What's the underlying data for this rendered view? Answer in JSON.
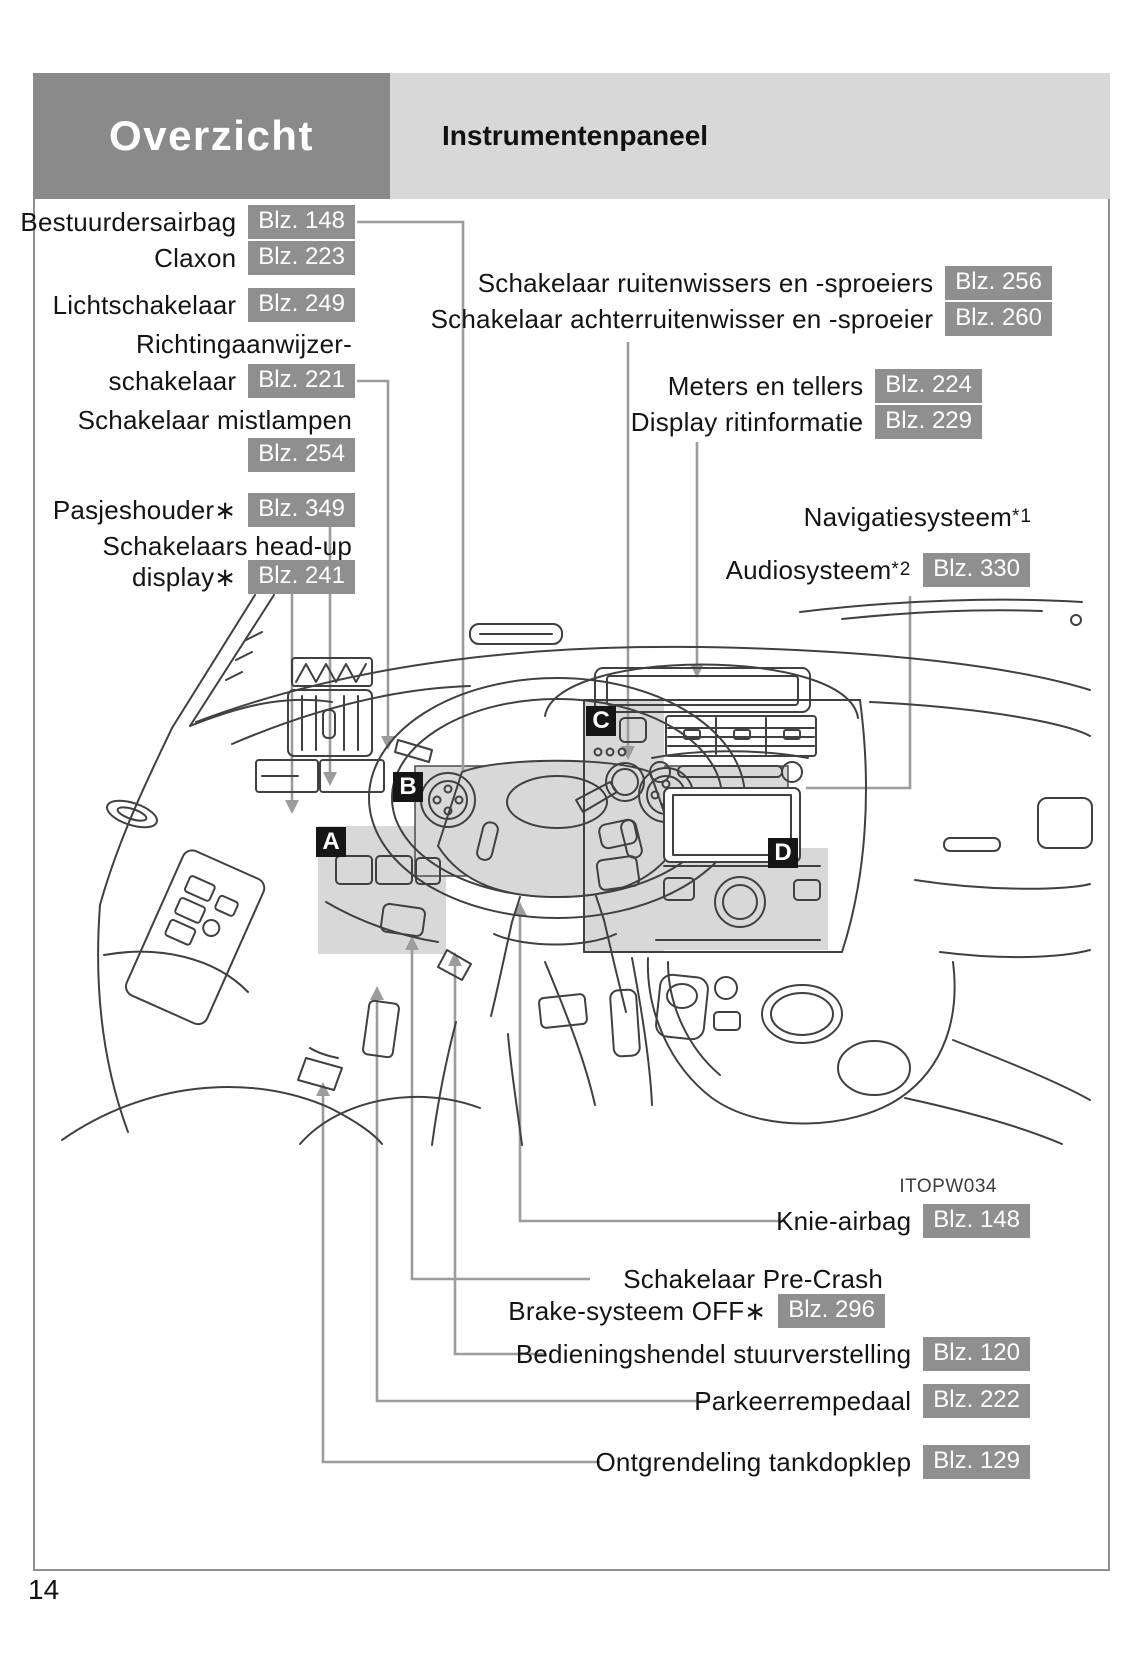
{
  "header": {
    "section": "Overzicht",
    "title": "Instrumentenpaneel"
  },
  "page": {
    "number": "14",
    "figure_code": "ITOPW034"
  },
  "colors": {
    "header_dark_bg": "#8a8a8a",
    "header_light_bg": "#d8d8d8",
    "badge_bg": "#8f8f8f",
    "badge_text": "#ffffff",
    "leader_line": "#9c9c9c",
    "line_art": "#404040",
    "highlight_region": "#d8d8d8",
    "marker_bg": "#161616",
    "marker_text": "#ffffff"
  },
  "labels": {
    "left": [
      {
        "text": "Bestuurdersairbag",
        "page": "Blz. 148"
      },
      {
        "text": "Claxon",
        "page": "Blz. 223"
      },
      {
        "text": "Lichtschakelaar",
        "page": "Blz. 249"
      },
      {
        "text": "Richtingaanwijzer-"
      },
      {
        "text": "schakelaar",
        "page": "Blz. 221"
      },
      {
        "text": "Schakelaar mistlampen"
      },
      {
        "page": "Blz. 254"
      },
      {
        "text": "Pasjeshouder∗",
        "page": "Blz. 349"
      },
      {
        "text": "Schakelaars head-up"
      },
      {
        "text": "display∗",
        "page": "Blz. 241"
      }
    ],
    "right": [
      {
        "text": "Schakelaar ruitenwissers en -sproeiers",
        "page": "Blz. 256"
      },
      {
        "text": "Schakelaar achterruitenwisser en -sproeier",
        "page": "Blz. 260"
      },
      {
        "text": "Meters en tellers",
        "page": "Blz. 224"
      },
      {
        "text": "Display ritinformatie",
        "page": "Blz. 229"
      },
      {
        "text": "Navigatiesysteem",
        "sup": "*1"
      },
      {
        "text": "Audiosysteem",
        "sup": "*2",
        "page": "Blz. 330"
      }
    ],
    "bottom": [
      {
        "text": "Knie-airbag",
        "page": "Blz. 148"
      },
      {
        "text": "Schakelaar Pre-Crash"
      },
      {
        "text": "Brake-systeem OFF∗",
        "page": "Blz. 296"
      },
      {
        "text": "Bedieningshendel stuurverstelling",
        "page": "Blz. 120"
      },
      {
        "text": "Parkeerrempedaal",
        "page": "Blz. 222"
      },
      {
        "text": "Ontgrendeling tankdopklep",
        "page": "Blz. 129"
      }
    ]
  },
  "diagram": {
    "markers": [
      {
        "letter": "A"
      },
      {
        "letter": "B"
      },
      {
        "letter": "C"
      },
      {
        "letter": "D"
      }
    ]
  }
}
